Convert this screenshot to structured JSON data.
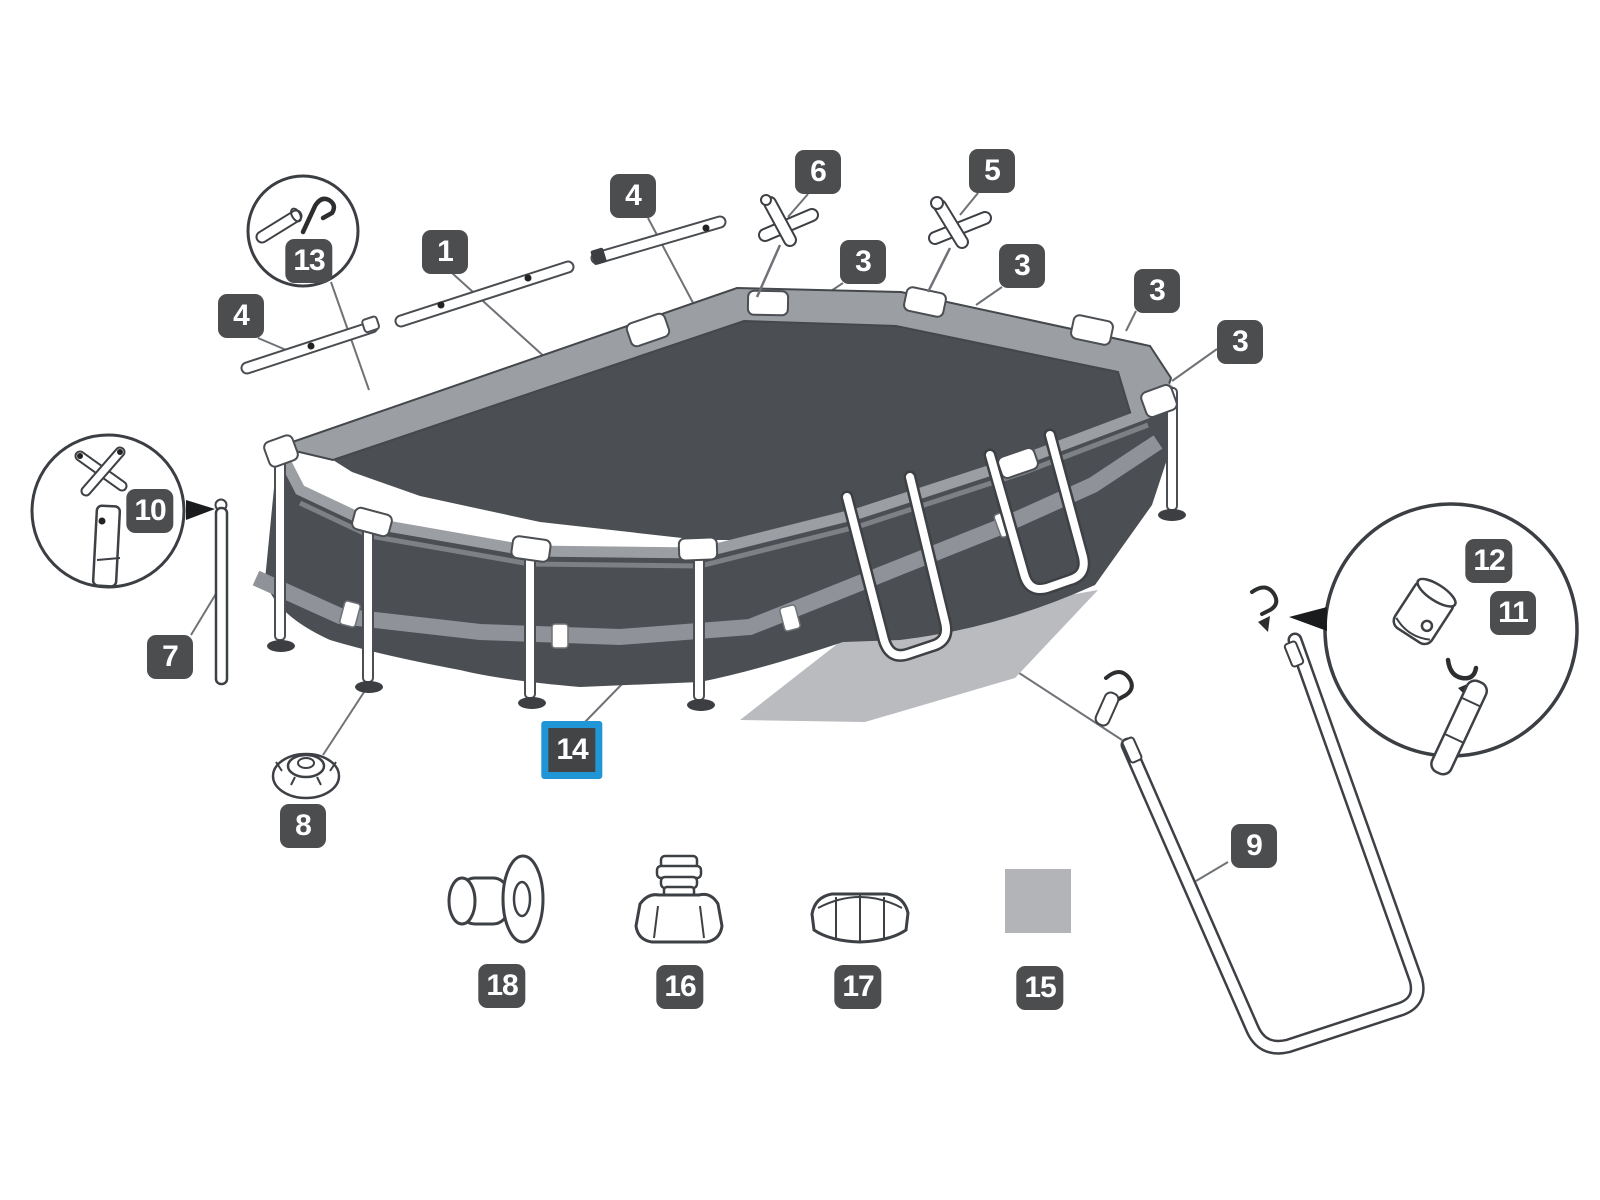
{
  "diagram": {
    "kind": "exploded-parts-diagram",
    "subject": "oval-frame-pool",
    "colors": {
      "highlight": "#2196d6",
      "label_background": "#4c4d4f",
      "label_text": "#ffffff",
      "pool_wall": "#4b4e53",
      "frame_rail": "#9b9ea3",
      "wall_band": "#8f9298",
      "ground_shadow": "#b9bbbe",
      "leader_line": "#6f7276"
    },
    "selected_part": "14"
  },
  "labels": [
    {
      "text": "1",
      "highlighted": false
    },
    {
      "text": "4",
      "highlighted": false
    },
    {
      "text": "4",
      "highlighted": false
    },
    {
      "text": "13",
      "highlighted": false
    },
    {
      "text": "6",
      "highlighted": false
    },
    {
      "text": "5",
      "highlighted": false
    },
    {
      "text": "3",
      "highlighted": false
    },
    {
      "text": "3",
      "highlighted": false
    },
    {
      "text": "3",
      "highlighted": false
    },
    {
      "text": "3",
      "highlighted": false
    },
    {
      "text": "10",
      "highlighted": false
    },
    {
      "text": "7",
      "highlighted": false
    },
    {
      "text": "8",
      "highlighted": false
    },
    {
      "text": "14",
      "highlighted": true
    },
    {
      "text": "9",
      "highlighted": false
    },
    {
      "text": "12",
      "highlighted": false
    },
    {
      "text": "11",
      "highlighted": false
    },
    {
      "text": "18",
      "highlighted": false
    },
    {
      "text": "16",
      "highlighted": false
    },
    {
      "text": "17",
      "highlighted": false
    },
    {
      "text": "15",
      "highlighted": false
    }
  ]
}
